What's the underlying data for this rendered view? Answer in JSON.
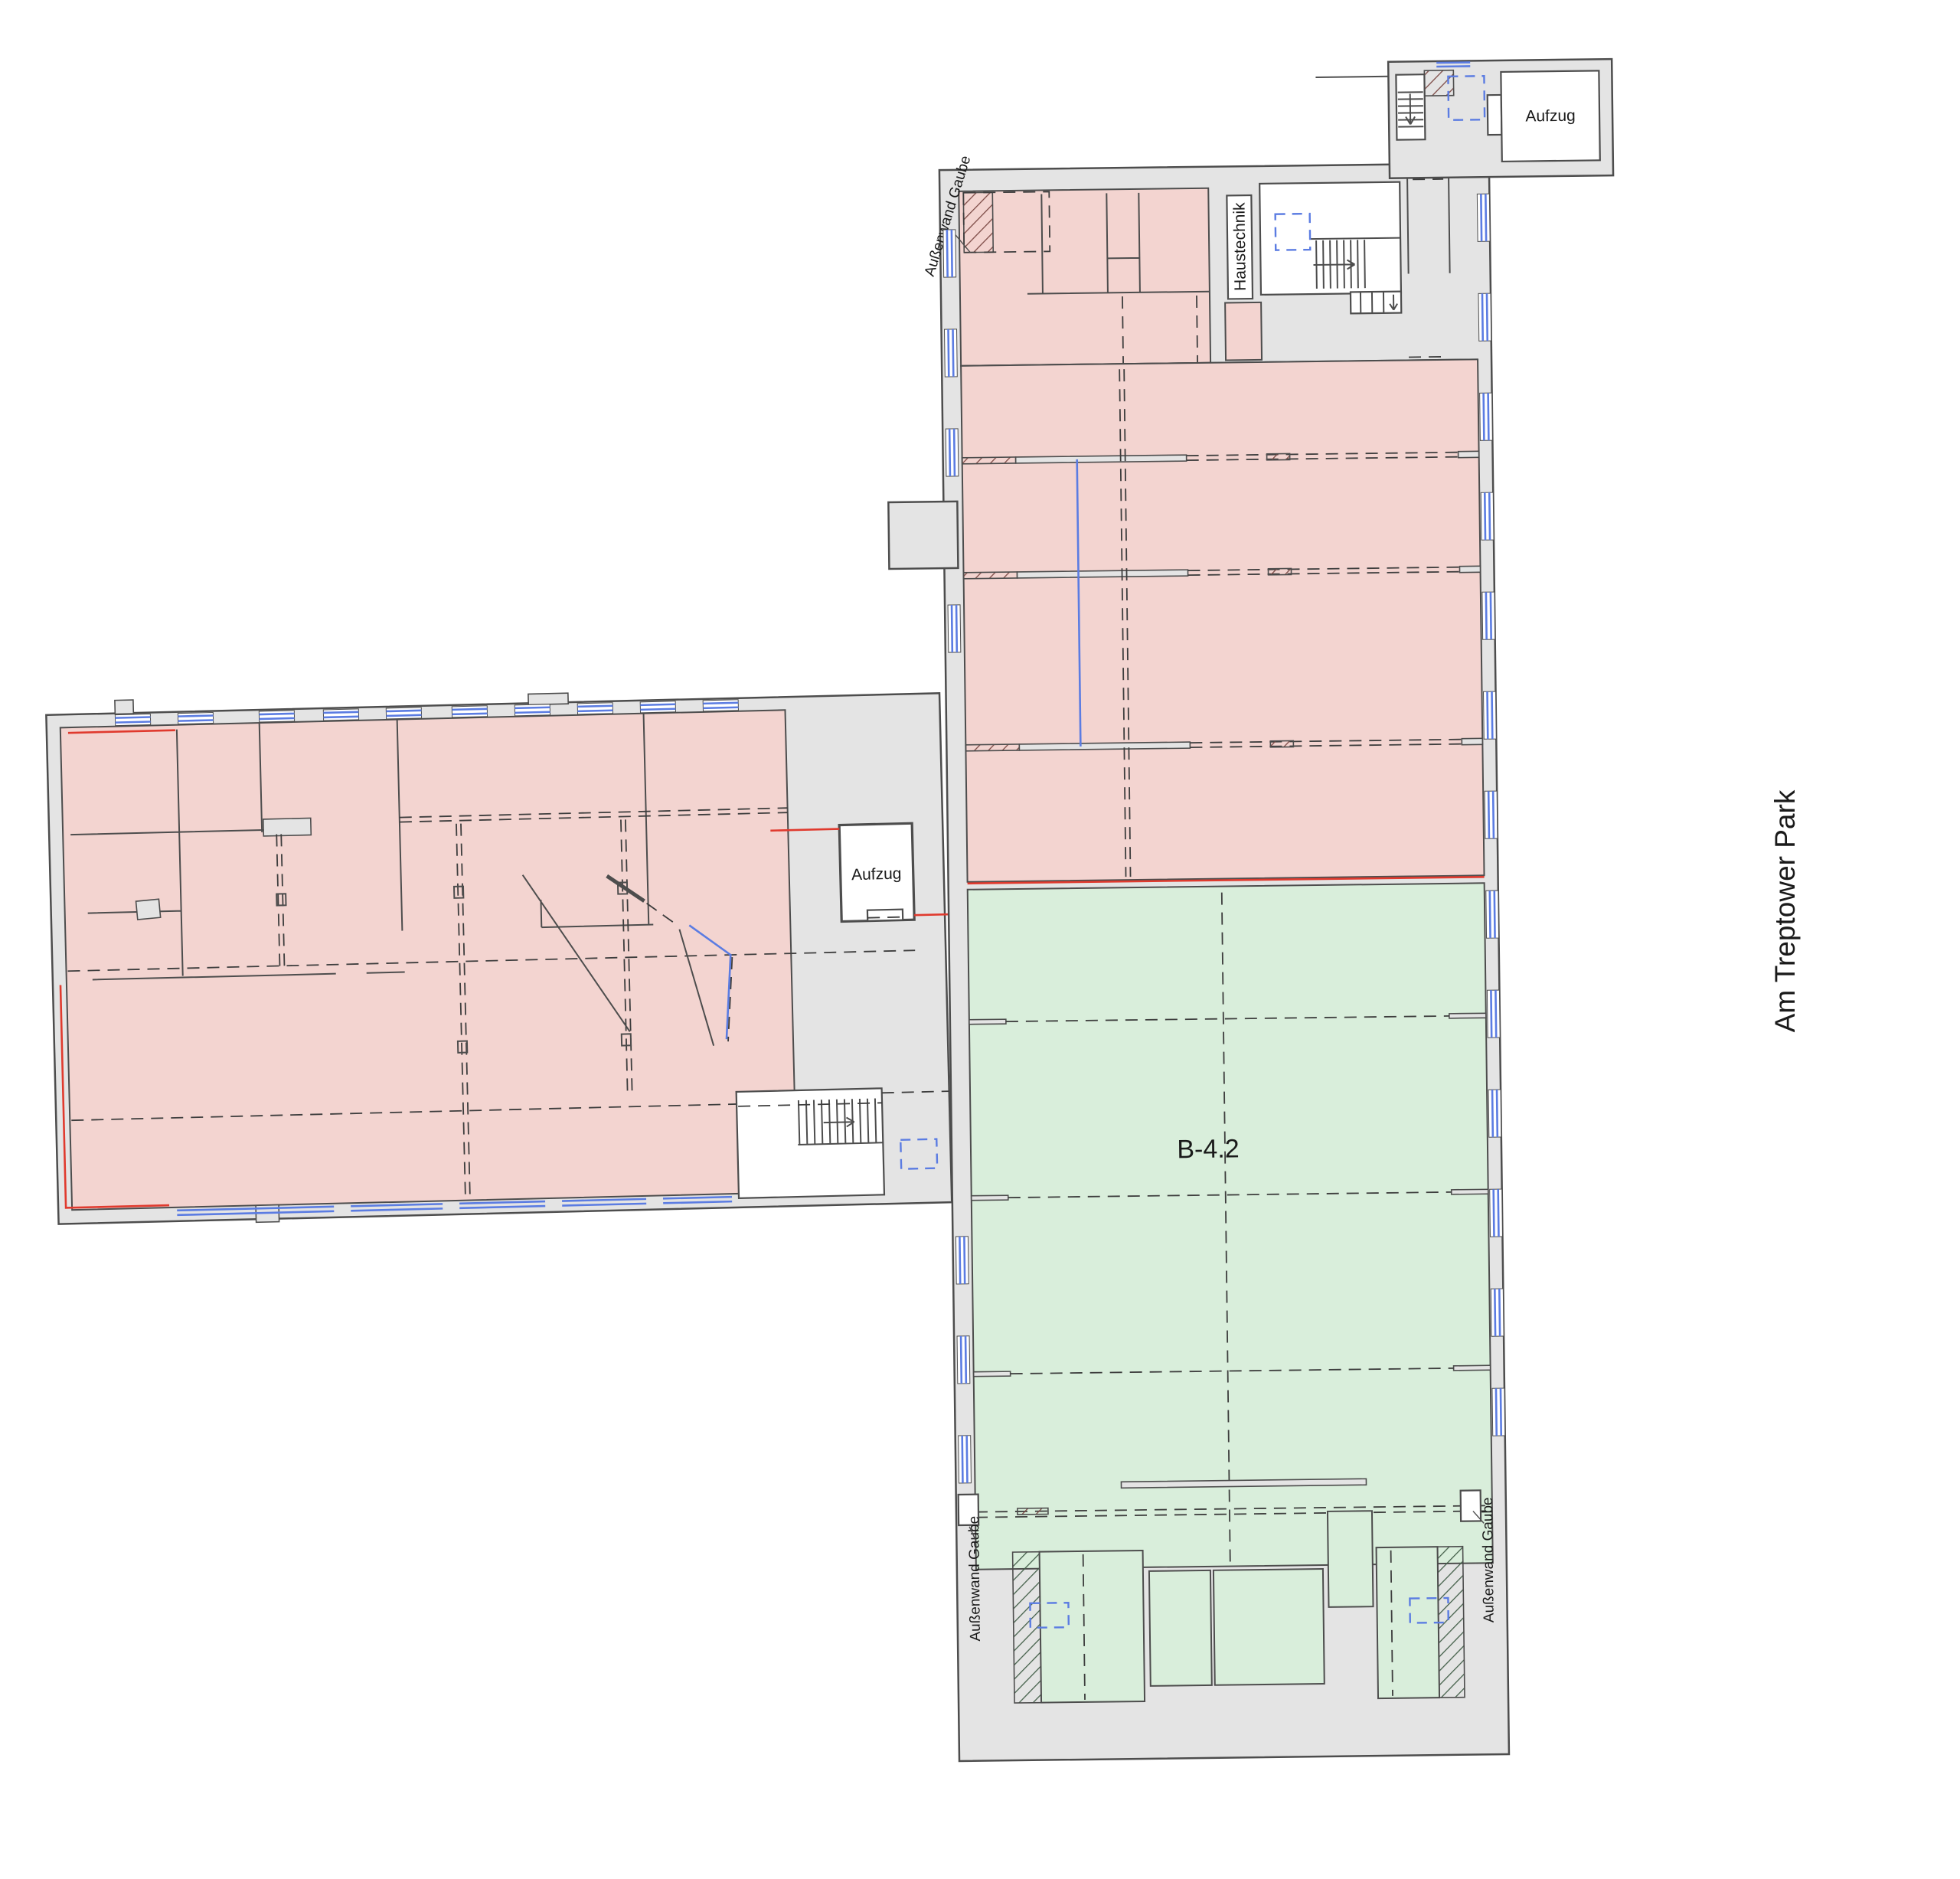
{
  "plan": {
    "street_label": "Am Treptower Park",
    "unit_label": "B-4.2",
    "elevator_top_label": "Aufzug",
    "elevator_mid_label": "Aufzug",
    "haustechnik_label": "Haustechnik",
    "dormer_label_top": "Außenwand Gaube",
    "dormer_label_bottom_left": "Außenwand Gaube",
    "dormer_label_bottom_right": "Außenwand Gaube"
  },
  "colors": {
    "pink": "#f3d4d0",
    "green": "#d9eedb",
    "gray": "#e4e4e4",
    "wall": "#4d4d4d",
    "dash": "#3d3d3d",
    "blue": "#5b7ce2",
    "red": "#e03a2e",
    "hatchr": "#7c4a45",
    "hatchg": "#44604a",
    "text": "#1a1a1a",
    "white": "#ffffff"
  }
}
